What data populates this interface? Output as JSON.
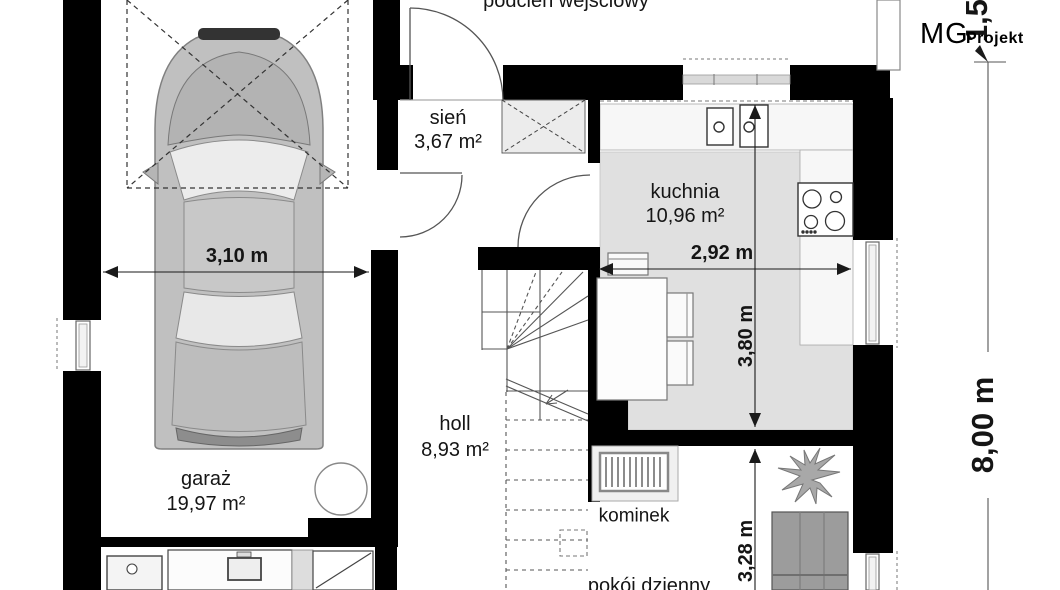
{
  "logo": {
    "mg": "MG",
    "projekt": "Projekt"
  },
  "rooms": {
    "porch": {
      "name": "podcień wejściowy"
    },
    "entry": {
      "name": "sień",
      "area": "3,67 m²"
    },
    "kitchen": {
      "name": "kuchnia",
      "area": "10,96 m²"
    },
    "hall": {
      "name": "holl",
      "area": "8,93 m²"
    },
    "garage": {
      "name": "garaż",
      "area": "19,97 m²"
    },
    "living": {
      "name": "pokój dzienny"
    },
    "fireplace": {
      "name": "kominek"
    }
  },
  "dimensions": {
    "garage_width": "3,10 m",
    "kitchen_width": "2,92 m",
    "kitchen_depth": "3,80 m",
    "living_depth": "3,28 m",
    "house_depth": "8,00 m",
    "porch_depth": "1,50"
  },
  "colors": {
    "wall": "#000000",
    "kitchen_floor": "#e0e0e0",
    "car_body": "#c0c0c0"
  }
}
